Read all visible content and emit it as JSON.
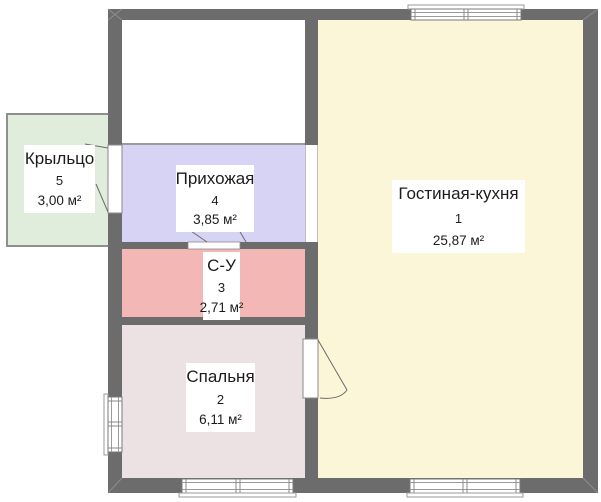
{
  "plan_title": "Floor plan",
  "colors": {
    "wall": "#6d6c6c",
    "opening_line": "#8a8a8a",
    "label_text": "#1c1c1c",
    "label_bg": "#ffffff",
    "living": "#fbf6d8",
    "bedroom": "#ece2e4",
    "bathroom": "#f3b7b5",
    "hallway": "#d6d3f4",
    "porch": "#e0ecdc",
    "unlabeled": "#ffffff"
  },
  "rooms": [
    {
      "id": "living",
      "name": "Гостиная-кухня",
      "number": "1",
      "area": "25,87 м²"
    },
    {
      "id": "bedroom",
      "name": "Спальня",
      "number": "2",
      "area": "6,11 м²"
    },
    {
      "id": "bathroom",
      "name": "С-У",
      "number": "3",
      "area": "2,71 м²"
    },
    {
      "id": "hallway",
      "name": "Прихожая",
      "number": "4",
      "area": "3,85 м²"
    },
    {
      "id": "porch",
      "name": "Крыльцо",
      "number": "5",
      "area": "3,00 м²"
    }
  ]
}
